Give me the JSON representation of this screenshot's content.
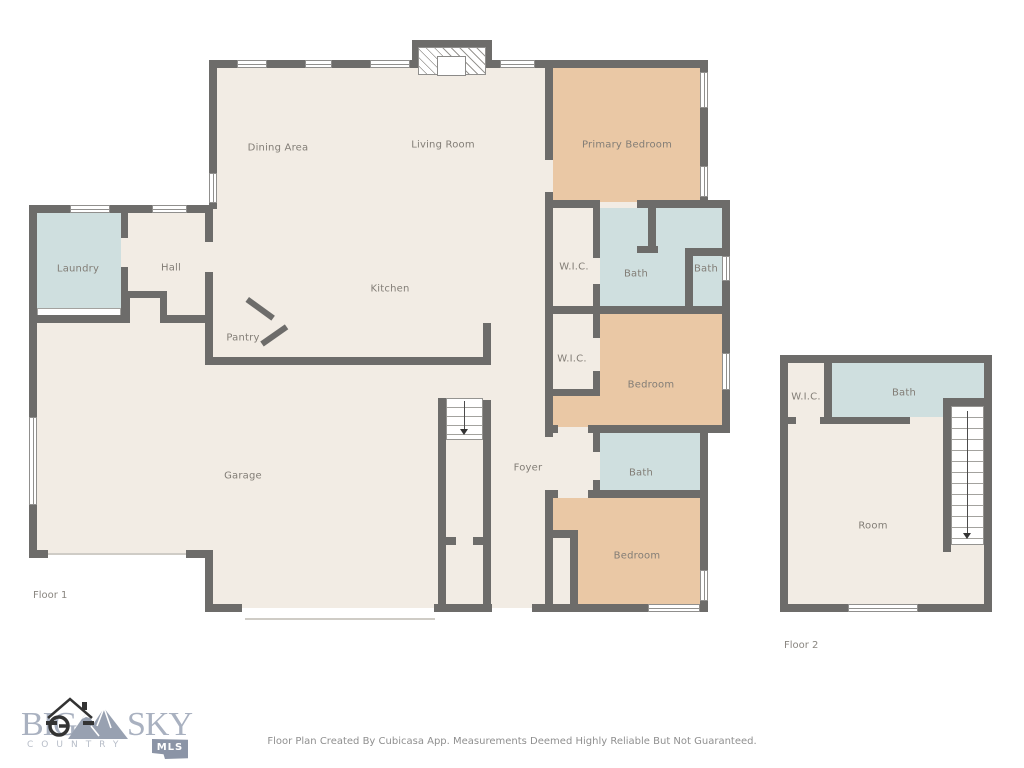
{
  "floor1": {
    "tag": "Floor 1",
    "rooms": {
      "dining": "Dining Area",
      "living": "Living Room",
      "primary": "Primary Bedroom",
      "laundry": "Laundry",
      "hall": "Hall",
      "kitchen": "Kitchen",
      "wic1": "W.I.C.",
      "bath1": "Bath",
      "bath2": "Bath",
      "pantry": "Pantry",
      "wic2": "W.I.C.",
      "bedroom2": "Bedroom",
      "garage": "Garage",
      "foyer": "Foyer",
      "bath3": "Bath",
      "bedroom3": "Bedroom"
    }
  },
  "floor2": {
    "tag": "Floor 2",
    "rooms": {
      "wic": "W.I.C.",
      "bath": "Bath",
      "room": "Room"
    }
  },
  "footer": {
    "disclaimer": "Floor Plan Created By Cubicasa App. Measurements Deemed Highly Reliable But Not Guaranteed."
  },
  "logo": {
    "word1": "BIG",
    "word2": "SKY",
    "tagline": "COUNTRY",
    "badge": "MLS"
  },
  "colors": {
    "wall": "#6d6c6a",
    "floor": "#f2ece4",
    "bedroom_fill": "#eac8a5",
    "wet_room_fill": "#cfdfdf",
    "label_text": "#827d76",
    "logo_text": "#a9b1c0"
  }
}
